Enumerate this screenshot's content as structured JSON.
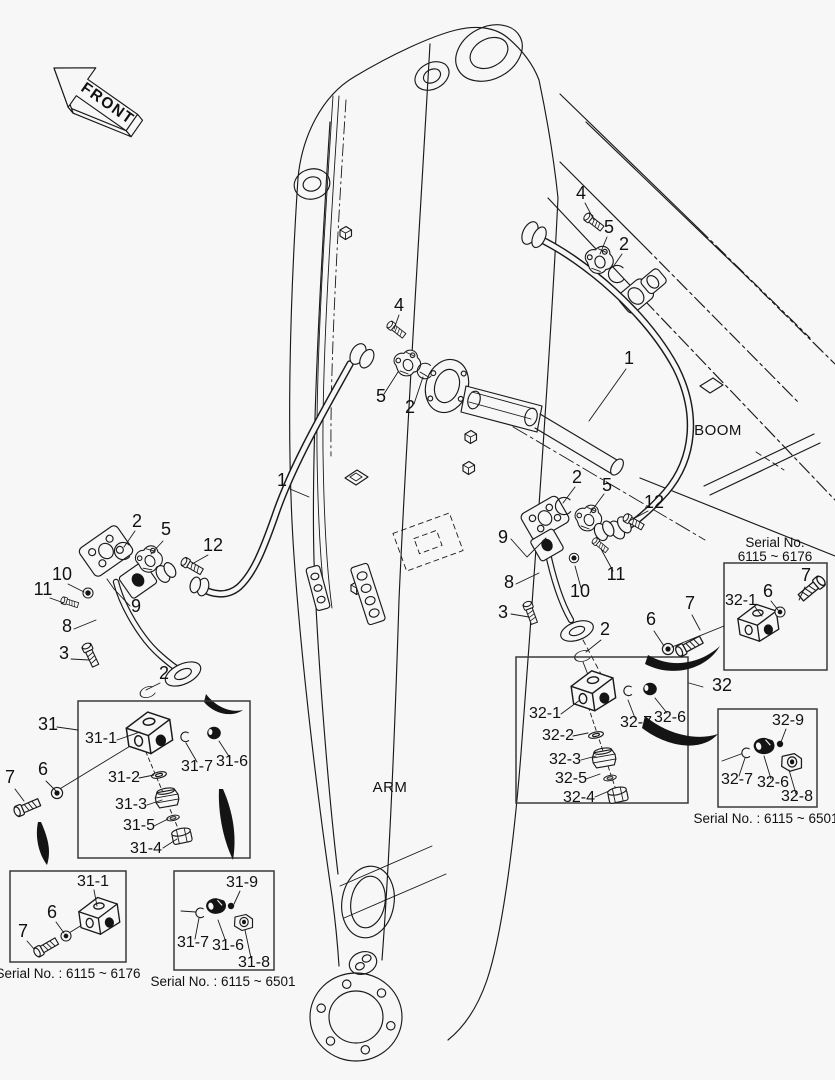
{
  "page": {
    "background": "#f7f7f7",
    "line_color": "#1a1a1a",
    "text_color": "#111111"
  },
  "region_labels": {
    "front": "FRONT",
    "boom": "BOOM",
    "arm": "ARM"
  },
  "part_numbers": {
    "p1": "1",
    "p2": "2",
    "p3": "3",
    "p4": "4",
    "p5": "5",
    "p6": "6",
    "p7": "7",
    "p8": "8",
    "p9": "9",
    "p10": "10",
    "p11": "11",
    "p12": "12",
    "p31": "31",
    "p32": "32",
    "p31_1": "31-1",
    "p31_2": "31-2",
    "p31_3": "31-3",
    "p31_4": "31-4",
    "p31_5": "31-5",
    "p31_6": "31-6",
    "p31_7": "31-7",
    "p31_8": "31-8",
    "p31_9": "31-9",
    "p32_1": "32-1",
    "p32_2": "32-2",
    "p32_3": "32-3",
    "p32_4": "32-4",
    "p32_5": "32-5",
    "p32_6": "32-6",
    "p32_7": "32-7",
    "p32_8": "32-8",
    "p32_9": "32-9"
  },
  "insets": {
    "upper_right": {
      "serial_title": "Serial No.",
      "serial_range": "6115 ~ 6176"
    },
    "lower_right": {
      "serial_caption": "Serial No. : 6115 ~ 6501"
    },
    "bottom_left": {
      "serial_caption": "Serial No. : 6115 ~ 6176"
    },
    "bottom_middle": {
      "serial_caption": "Serial No. : 6115 ~ 6501"
    }
  }
}
